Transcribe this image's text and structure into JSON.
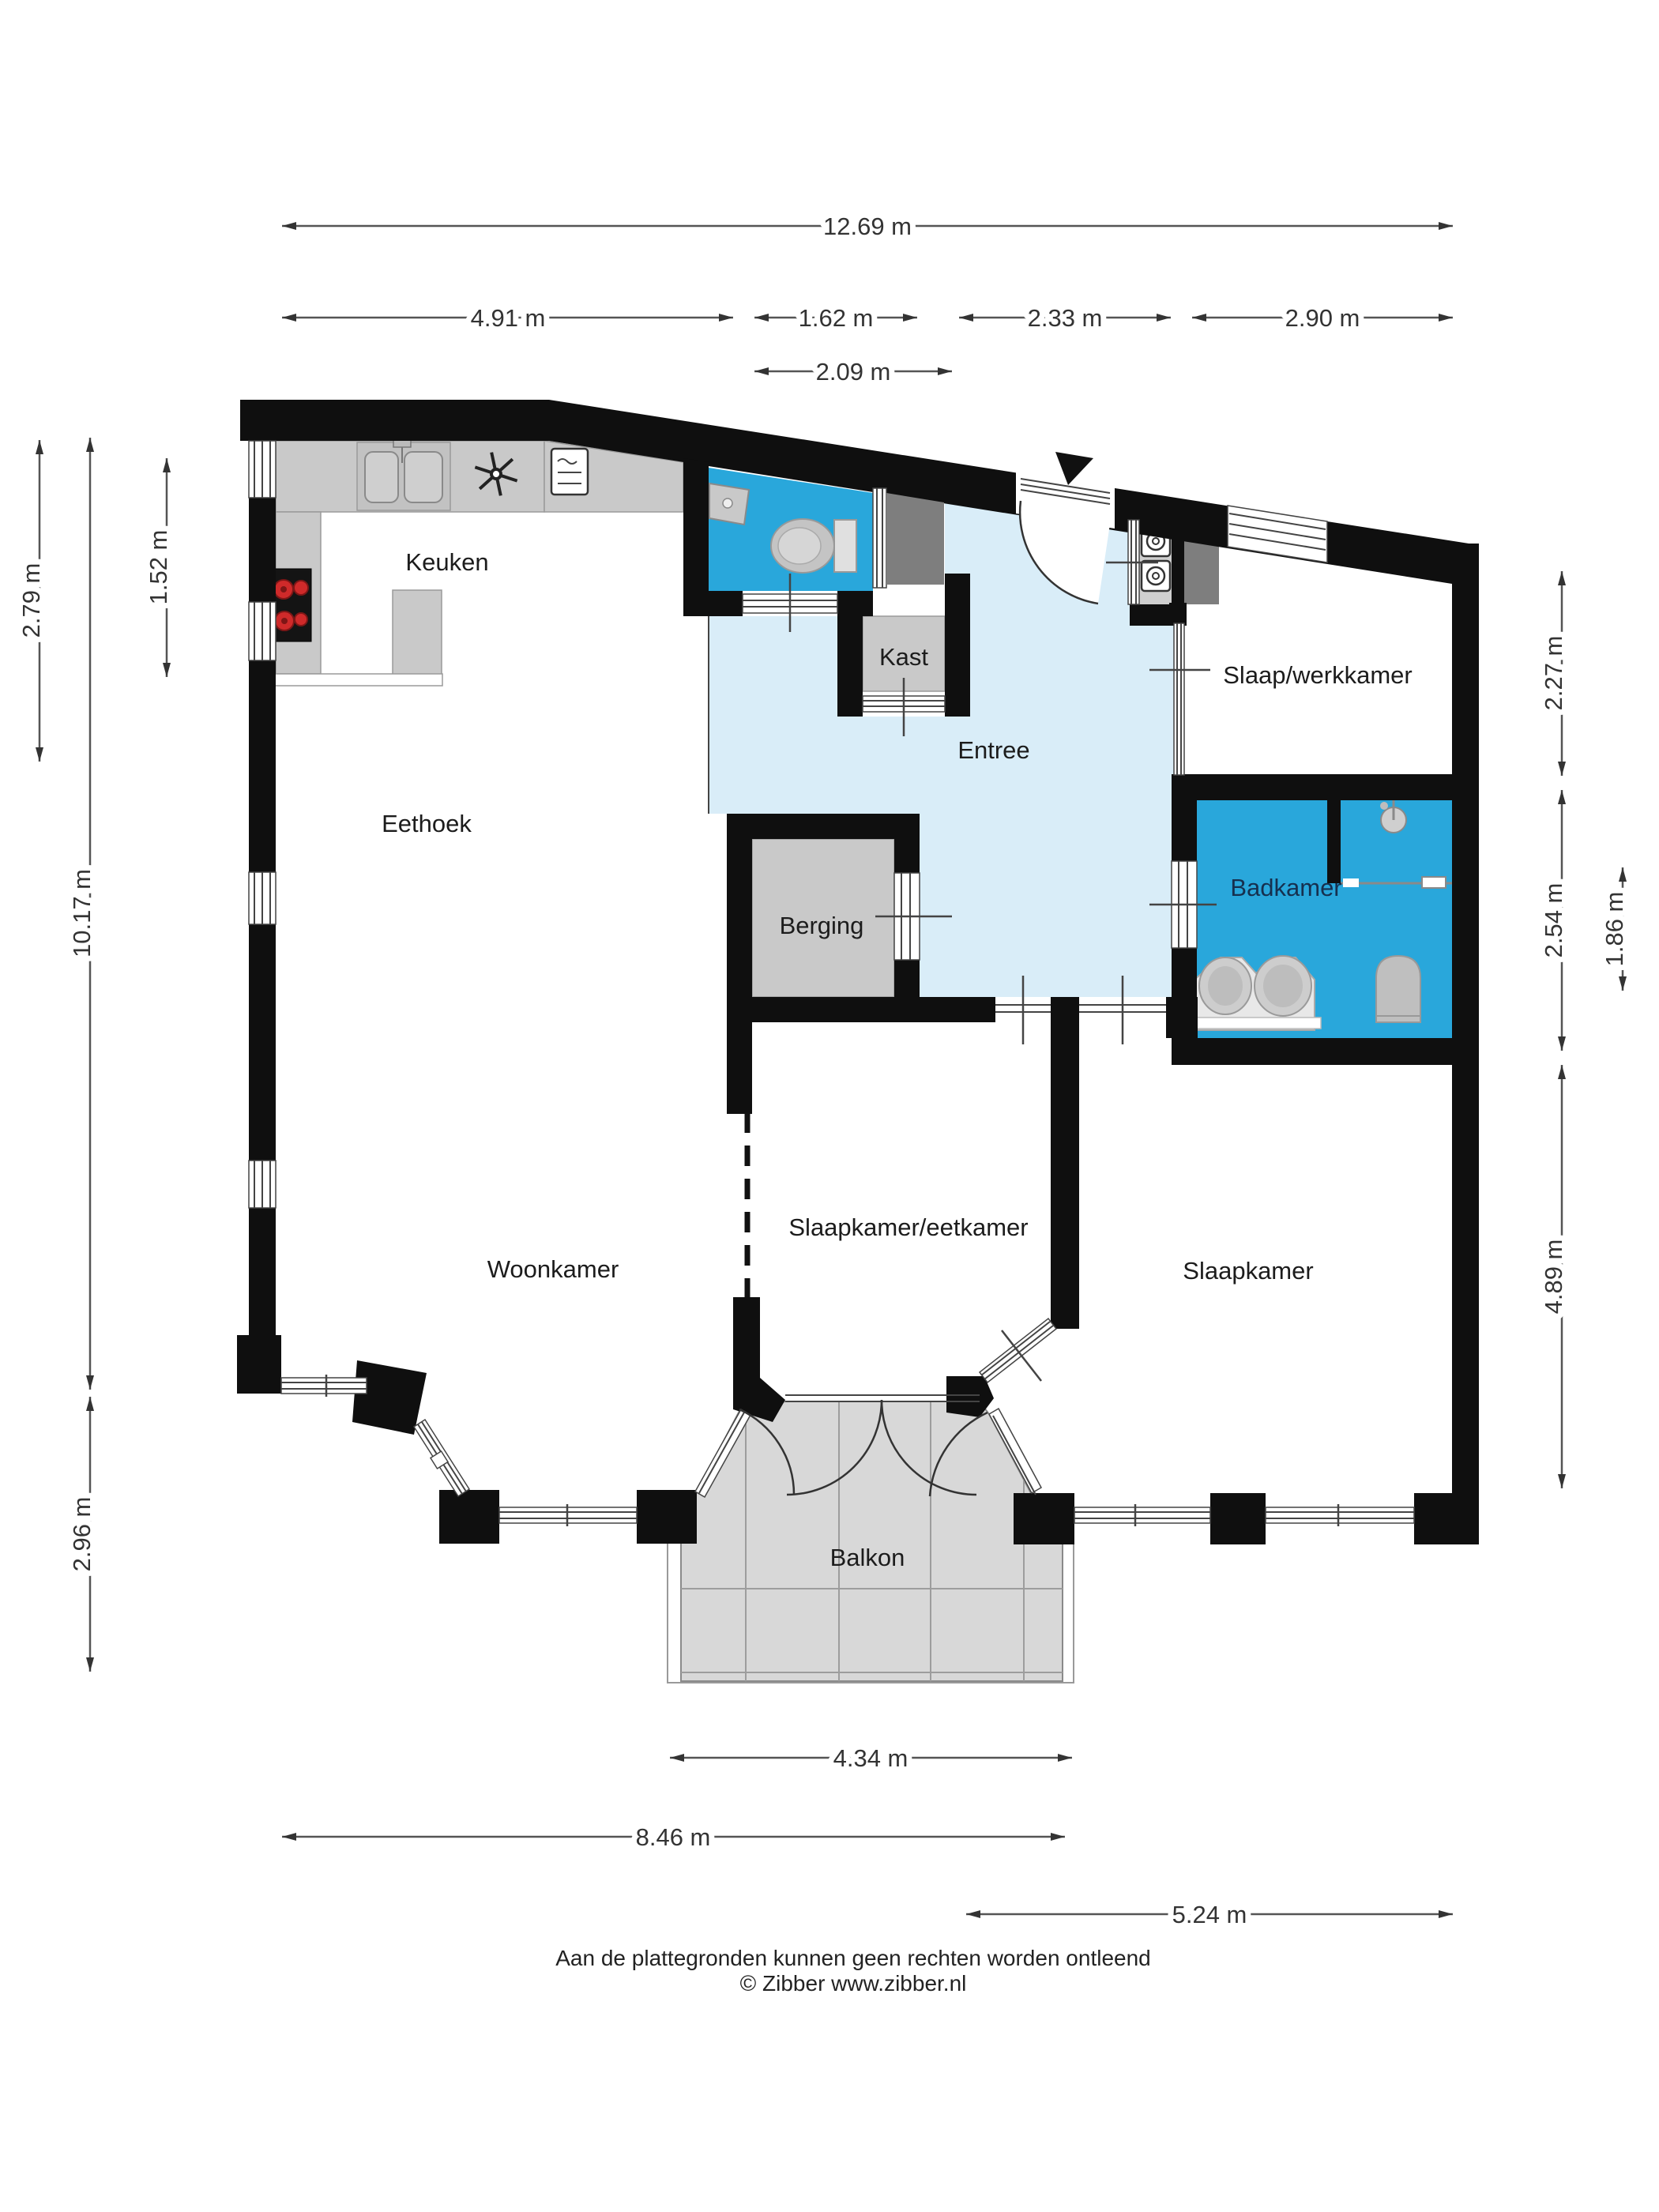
{
  "title": "Floor plan (plattegrond)",
  "rooms": {
    "keuken": {
      "label": "Keuken"
    },
    "eethoek": {
      "label": "Eethoek"
    },
    "woonkamer": {
      "label": "Woonkamer"
    },
    "entree": {
      "label": "Entree"
    },
    "kast": {
      "label": "Kast"
    },
    "berging": {
      "label": "Berging"
    },
    "slaap_werkkamer": {
      "label": "Slaap/werkkamer"
    },
    "badkamer": {
      "label": "Badkamer"
    },
    "slaapkamer_eetkamer": {
      "label": "Slaapkamer/eetkamer"
    },
    "slaapkamer": {
      "label": "Slaapkamer"
    },
    "balkon": {
      "label": "Balkon"
    }
  },
  "dimensions": {
    "total_width": {
      "label": "12.69 m"
    },
    "kitchen_width": {
      "label": "4.91 m"
    },
    "toilet_width": {
      "label": "1.62 m"
    },
    "entree_width": {
      "label": "2.33 m"
    },
    "werkkamer_width": {
      "label": "2.90 m"
    },
    "kast_width": {
      "label": "2.09 m"
    },
    "left_top": {
      "label": "2.79 m"
    },
    "kitchen_window": {
      "label": "1.52 m"
    },
    "left_total": {
      "label": "10.17 m"
    },
    "left_bottom": {
      "label": "2.96 m"
    },
    "right_top": {
      "label": "2.27 m"
    },
    "badkamer_height": {
      "label": "2.54 m"
    },
    "badkamer_inner": {
      "label": "1.86 m"
    },
    "slaapkamer_height": {
      "label": "4.89 m"
    },
    "balkon_width": {
      "label": "4.34 m"
    },
    "bottom_width": {
      "label": "8.46 m"
    },
    "bottom_right": {
      "label": "5.24 m"
    }
  },
  "footer": {
    "line1": "Aan de plattegronden kunnen geen rechten worden ontleend",
    "line2": "© Zibber www.zibber.nl"
  },
  "icons": [
    "kitchen-sink",
    "extractor-hood",
    "oven",
    "stove",
    "kitchen-island",
    "wc-toilet",
    "corner-basin",
    "washer",
    "dryer",
    "shower-head",
    "double-vanity",
    "bathroom-toilet",
    "entry-arrow",
    "door-swing",
    "window-band"
  ],
  "colors": {
    "wall": "#0f0f0f",
    "wet": "#29a7db",
    "entree": "#d9edf8",
    "furniture": "#c9c9c9",
    "closet": "#7e7e7e",
    "balcony": "#d8d8d8",
    "burner": "#cf2a2a"
  }
}
